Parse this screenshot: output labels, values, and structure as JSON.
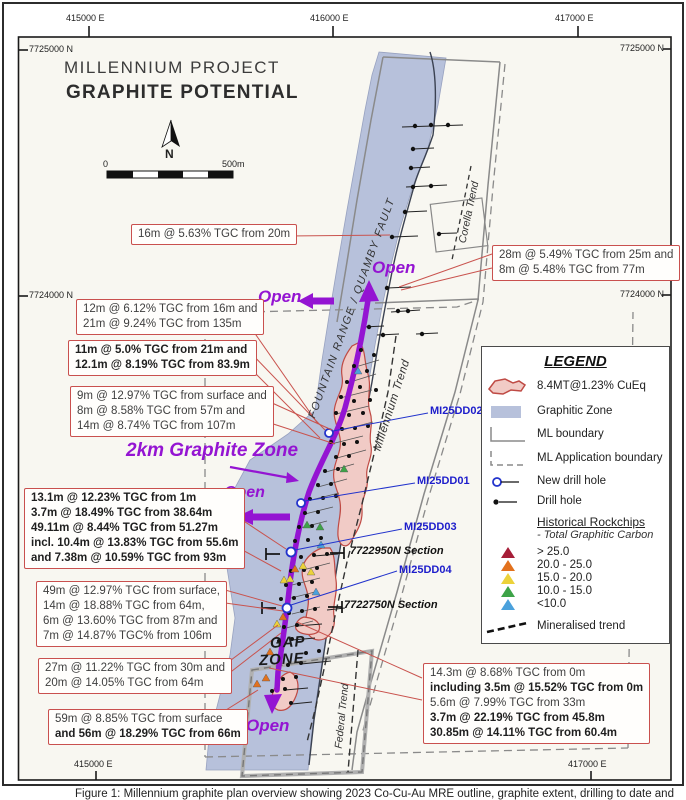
{
  "palette": {
    "graphitic_zone": "#b7c1db",
    "mre_fill": "#f1cbc6",
    "mre_border": "#bf4a44",
    "purple_accent": "#9414d2",
    "annotation_border": "#c9504e",
    "new_hole_blue": "#2233cc",
    "label_blue": "#1d1dcb"
  },
  "header": {
    "title1": "MILLENNIUM PROJECT",
    "title2": "GRAPHITE POTENTIAL"
  },
  "compass_label": "N",
  "scale_bar": {
    "start": "0",
    "end": "500m"
  },
  "grid": {
    "top": [
      {
        "label": "415000 E"
      },
      {
        "label": "416000 E"
      },
      {
        "label": "417000 E"
      }
    ],
    "bottom": [
      {
        "label": "415000 E"
      },
      {
        "label": "417000 E"
      }
    ],
    "left": [
      {
        "label": "7725000 N"
      },
      {
        "label": "7724000 N"
      }
    ],
    "right": [
      {
        "label": "7725000 N"
      },
      {
        "label": "7724000 N"
      }
    ]
  },
  "map_labels": {
    "fault": "FOUNTAIN RANGE / QUAMBY FAULT",
    "corella_trend": "Corella Trend",
    "millennium_trend": "Millennium Trend",
    "federal_trend": "Federal Trend",
    "graphite_zone": "2km Graphite Zone",
    "gap_zone_line1": "GAP",
    "gap_zone_line2": "ZONE",
    "open1": "Open",
    "open2": "Open",
    "open3": "Open",
    "open4": "Open"
  },
  "drill_hole_labels": [
    {
      "name": "MI25DD02"
    },
    {
      "name": "MI25DD01"
    },
    {
      "name": "MI25DD03"
    },
    {
      "name": "MI25DD04"
    }
  ],
  "section_labels": [
    {
      "name": "7722950N Section"
    },
    {
      "name": "7722750N Section"
    }
  ],
  "annotations": [
    {
      "id": "a",
      "lines": [
        "16m @ 5.63% TGC from 20m"
      ]
    },
    {
      "id": "b",
      "lines": [
        "28m @ 5.49% TGC from 25m and",
        "8m @ 5.48% TGC from 77m"
      ]
    },
    {
      "id": "c",
      "lines": [
        "12m @ 6.12% TGC from 16m and",
        "21m @ 9.24% TGC from 135m"
      ]
    },
    {
      "id": "d",
      "lines": [
        "11m @ 5.0% TGC from 21m and",
        "12.1m @ 8.19% TGC from 83.9m"
      ]
    },
    {
      "id": "e",
      "lines": [
        "9m @ 12.97% TGC from surface and",
        "8m @ 8.58% TGC from 57m and",
        "14m @ 8.74% TGC from 107m"
      ]
    },
    {
      "id": "f",
      "lines": [
        "13.1m @ 12.23% TGC from 1m",
        "3.7m @ 18.49% TGC from 38.64m",
        "49.11m @ 8.44% TGC from 51.27m",
        "incl. 10.4m @ 13.83% TGC from 55.6m",
        "and 7.38m @ 10.59% TGC from 93m"
      ]
    },
    {
      "id": "g",
      "lines": [
        "49m @ 12.97% TGC from surface,",
        "14m @ 18.88% TGC from 64m,",
        "6m @ 13.60% TGC from 87m and",
        "7m @ 14.87% TGC% from 106m"
      ]
    },
    {
      "id": "h",
      "lines": [
        "27m @ 11.22% TGC from 30m and",
        "20m @ 14.05% TGC from 64m"
      ]
    },
    {
      "id": "i",
      "lines": [
        "59m @ 8.85% TGC from surface",
        "and 56m @ 18.29% TGC from 66m"
      ]
    },
    {
      "id": "j",
      "lines": [
        "14.3m @ 8.68% TGC from 0m",
        "including 3.5m @ 15.52% TGC from 0m",
        "5.6m @ 7.99% TGC from 33m",
        "3.7m @ 22.19% TGC from 45.8m",
        "30.85m @ 14.11% TGC from 60.4m"
      ]
    }
  ],
  "legend": {
    "title": "LEGEND",
    "items": [
      {
        "label": "8.4MT@1.23% CuEq"
      },
      {
        "label": "Graphitic Zone"
      },
      {
        "label": "ML boundary"
      },
      {
        "label": "ML Application boundary"
      },
      {
        "label": "New drill hole"
      },
      {
        "label": "Drill hole"
      }
    ],
    "rockchips_title": "Historical Rockchips",
    "rockchips_subtitle": "- Total Graphitic Carbon",
    "rockchip_classes": [
      {
        "label": "> 25.0",
        "color": "#a61e38"
      },
      {
        "label": "20.0 - 25.0",
        "color": "#e2711d"
      },
      {
        "label": "15.0 - 20.0",
        "color": "#ecd23a"
      },
      {
        "label": "10.0 - 15.0",
        "color": "#3da348"
      },
      {
        "label": "<10.0",
        "color": "#4ba1dc"
      }
    ],
    "mineralised_label": "Mineralised trend"
  },
  "caption": "Figure 1: Millennium graphite plan overview showing 2023 Co-Cu-Au MRE outline, graphite extent, drilling to date and"
}
